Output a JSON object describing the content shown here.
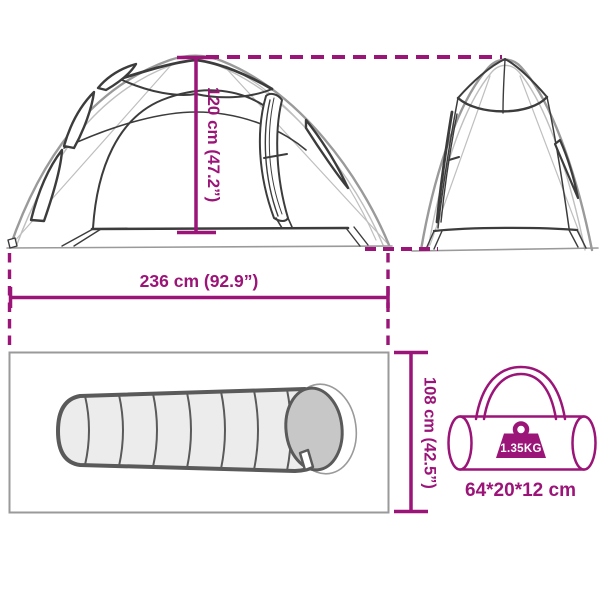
{
  "colors": {
    "accent": "#9b1478",
    "line_gray": "#9a9a9a",
    "line_gray_light": "#bfbfbf",
    "line_dark": "#3c3c3c",
    "bag_outline": "#5a5a5a",
    "bag_fill": "#ececec",
    "hood_fill": "#c7c7c7",
    "border_gray": "#858585",
    "white": "#ffffff"
  },
  "diagram": {
    "tent_height": {
      "label": "120 cm (47.2”)"
    },
    "tent_width": {
      "label": "236 cm (92.9”)"
    },
    "inner_height": {
      "label": "108 cm (42.5”)"
    },
    "packed_size": {
      "label": "64*20*12 cm"
    },
    "weight": {
      "label": "1.35KG"
    }
  }
}
